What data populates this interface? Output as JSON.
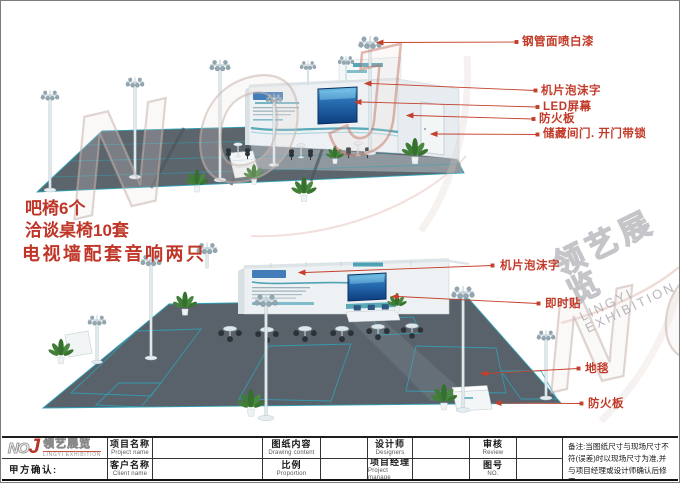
{
  "brand": {
    "no": "NO",
    "j": "J",
    "cn": "领艺展览",
    "en": "LINGYI EXHIBITION"
  },
  "annotations": {
    "notes": [
      "吧椅6个",
      "洽谈桌椅10套",
      "电视墙配套音响两只"
    ],
    "top_callouts": [
      "钢管面喷白漆",
      "机片泡沫字",
      "LED屏幕",
      "防火板",
      "储藏间门. 开门带锁"
    ],
    "bottom_callouts": [
      "机片泡沫字",
      "即时贴",
      "地毯",
      "防火板"
    ]
  },
  "title_block": {
    "confirm": "甲方确认:",
    "row1": [
      {
        "cn": "项目名称",
        "en": "Project name"
      },
      {
        "cn": "图纸内容",
        "en": "Drawing content"
      },
      {
        "cn": "设计师",
        "en": "Designers"
      },
      {
        "cn": "审核",
        "en": "Review"
      }
    ],
    "row2": [
      {
        "cn": "客户名称",
        "en": "Client name"
      },
      {
        "cn": "比例",
        "en": "Proportion"
      },
      {
        "cn": "项目经理",
        "en": "Project manage"
      },
      {
        "cn": "图号",
        "en": "NO."
      }
    ],
    "remark": "备注:当图纸尺寸与现场尺寸不符(误差)时以现场尺寸为准,并与项目经理或设计师确认后修正"
  },
  "colors": {
    "callout_red": "#c23a28",
    "note_red": "#bf3527",
    "teal": "#2790a5",
    "carpet": "#5c656c"
  }
}
